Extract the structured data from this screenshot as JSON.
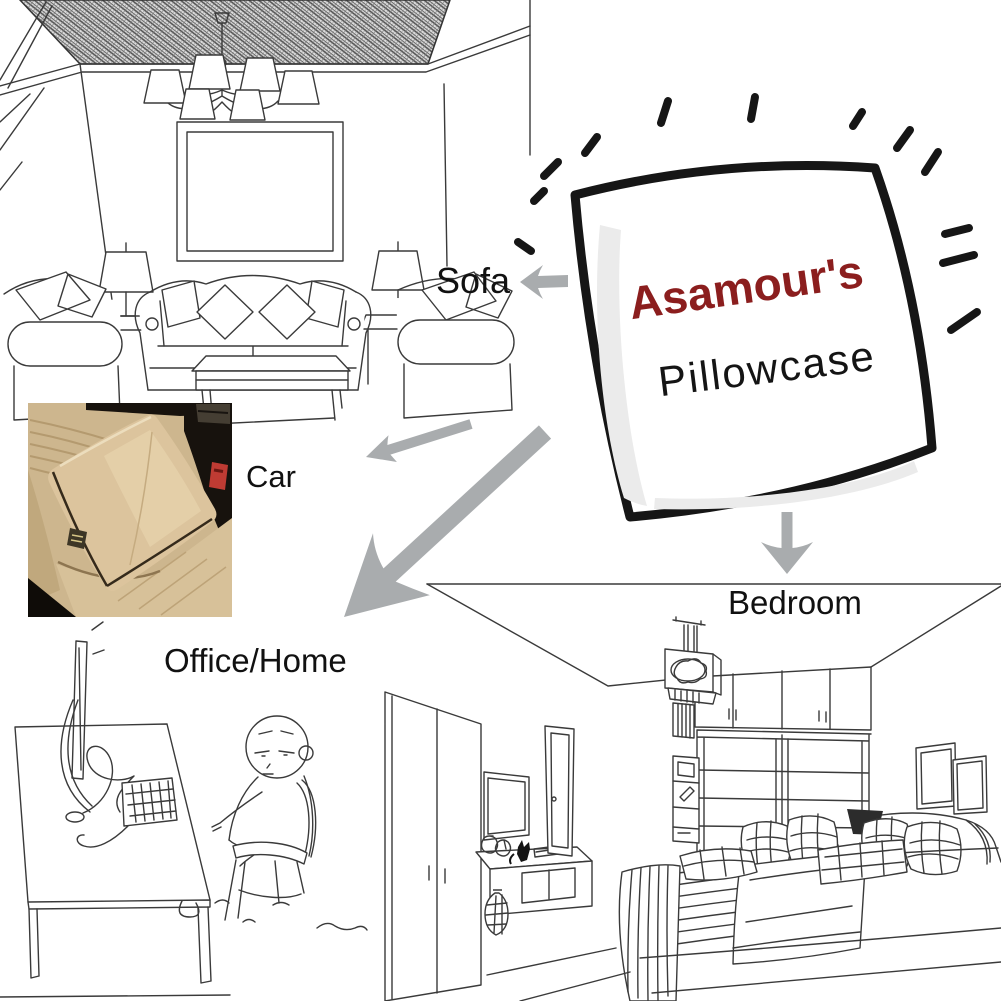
{
  "pillow": {
    "brand": "Asamour's",
    "product_line": "Pillowcase"
  },
  "usage_labels": {
    "sofa": "Sofa",
    "car": "Car",
    "office_home": "Office/Home",
    "bedroom": "Bedroom"
  },
  "scenes": [
    {
      "id": "living-room",
      "label": "Sofa"
    },
    {
      "id": "car-seat",
      "label": "Car"
    },
    {
      "id": "office-home",
      "label": "Office/Home"
    },
    {
      "id": "bedroom",
      "label": "Bedroom"
    }
  ],
  "colors": {
    "brand_text": "#8b1e1e",
    "product_text": "#141414",
    "label_text": "#111111",
    "arrow_gray": "#a9acae",
    "sketch_line": "#3a3a3a",
    "pillow_outline": "#161616",
    "photo_seat_beige": "#cdb68e",
    "photo_pillow_beige": "#dcc49d",
    "photo_dark": "#17120d",
    "photo_buckle_red": "#bf3b33"
  }
}
